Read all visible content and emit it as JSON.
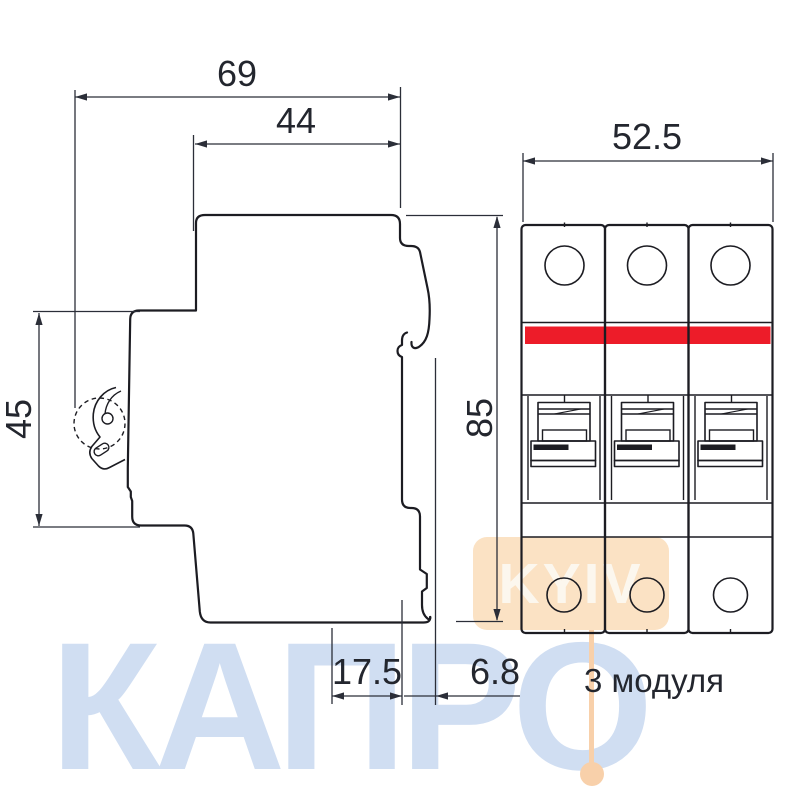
{
  "drawing": {
    "title_dimensions": {
      "total_depth": "69",
      "upper_depth": "44",
      "front_width": "52.5",
      "rear_height": "45",
      "front_height": "85",
      "module_width": "17.5",
      "clip_depth": "6.8"
    },
    "caption": "3 модуля",
    "colors": {
      "red_band": "#ed1c29",
      "outline": "#1c1c22",
      "dimension": "#2b2e38"
    }
  },
  "watermarks": {
    "brand": "КАПРО",
    "brand_color": "#d0def2",
    "city": "KYIV",
    "box_color": "#fbe2c4",
    "marker_color": "#f8d0aa"
  }
}
